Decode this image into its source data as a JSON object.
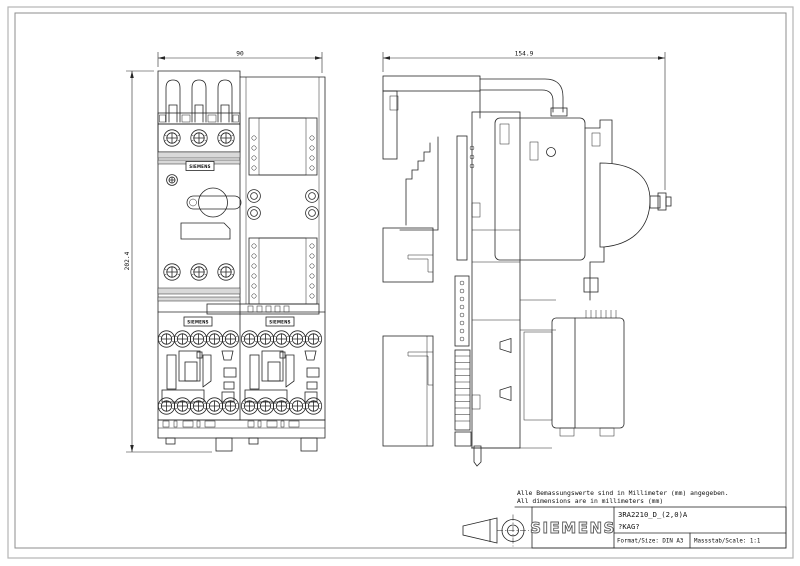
{
  "notes": {
    "line1": "Alle Bemassungswerte sind in Millimeter (mm) angegeben.",
    "line2": "All dimensions are in millimeters (mm)"
  },
  "dimensions": {
    "front_width": "90",
    "side_depth": "154.9",
    "front_height": "202.4"
  },
  "device": {
    "brand_label": "SIEMENS"
  },
  "title_block": {
    "brand": "SIEMENS",
    "model": "3RA2210_D_(2,0)A",
    "code": "?KAG?",
    "format": "Format/Size: DIN A3",
    "scale": "Massstab/Scale: 1:1"
  },
  "colors": {
    "line": "#262626",
    "frame": "#b5b5b5",
    "band_fill": "#d9d9d9",
    "background": "#ffffff"
  }
}
